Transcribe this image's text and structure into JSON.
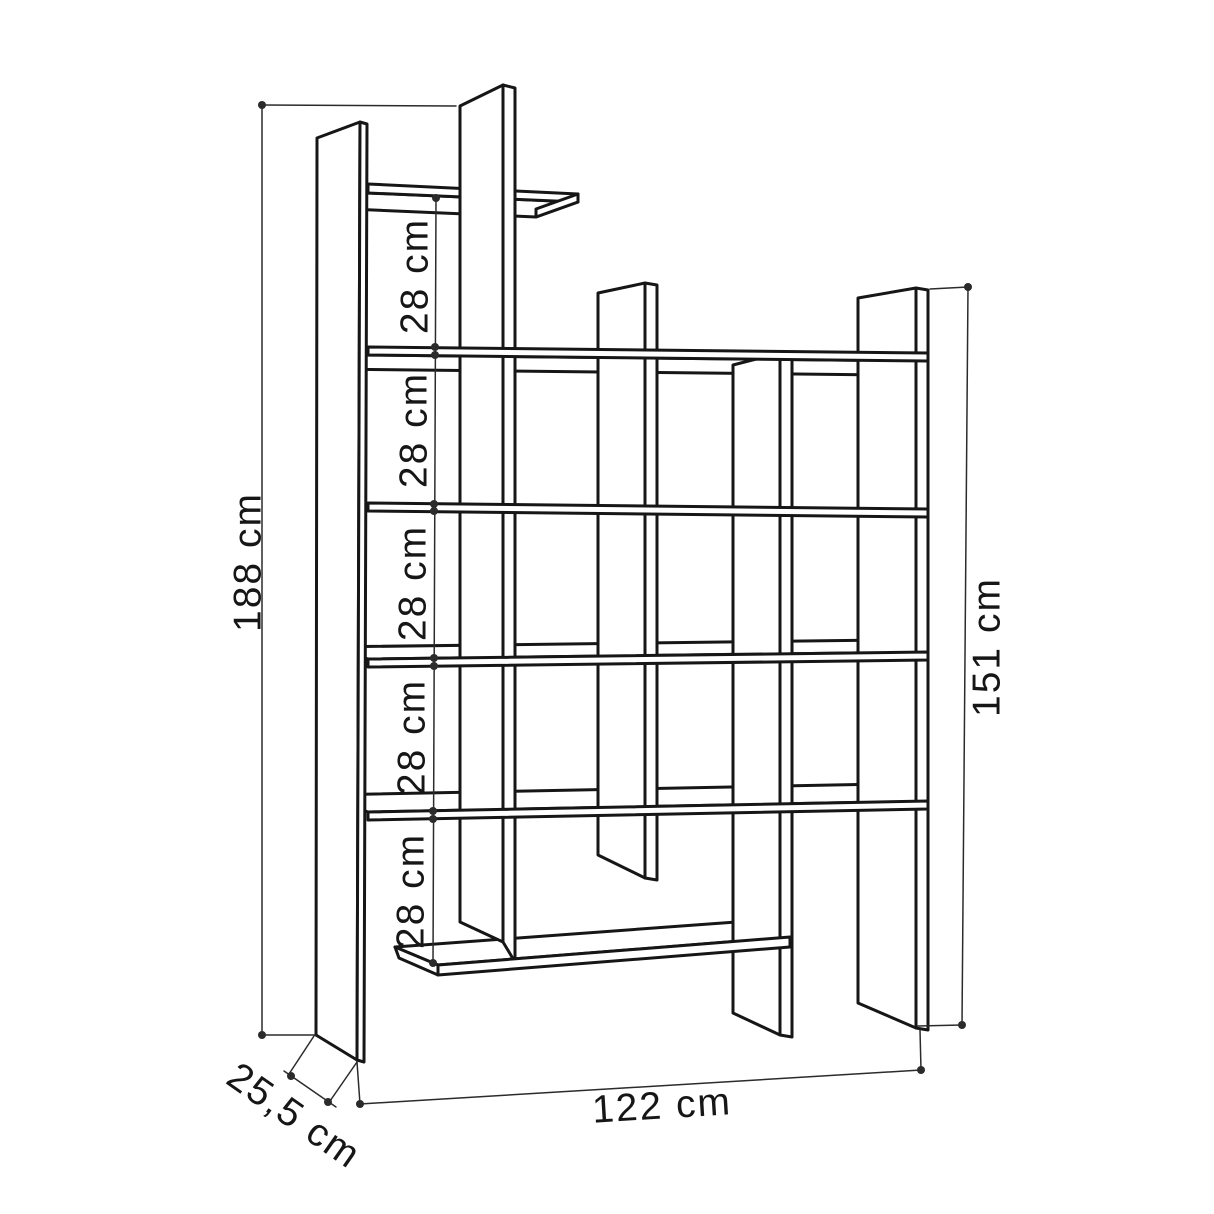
{
  "diagram": {
    "kind": "furniture-dimension-drawing",
    "dimensions": {
      "total_height": "188 cm",
      "right_section_height": "151 cm",
      "width": "122 cm",
      "depth": "25,5 cm",
      "shelf_gaps": [
        "28 cm",
        "28 cm",
        "28 cm",
        "28 cm",
        "28 cm"
      ]
    },
    "colors": {
      "outline": "#161616",
      "dimension_line": "#2b2b2b",
      "label": "#161616",
      "background": "#ffffff"
    }
  }
}
